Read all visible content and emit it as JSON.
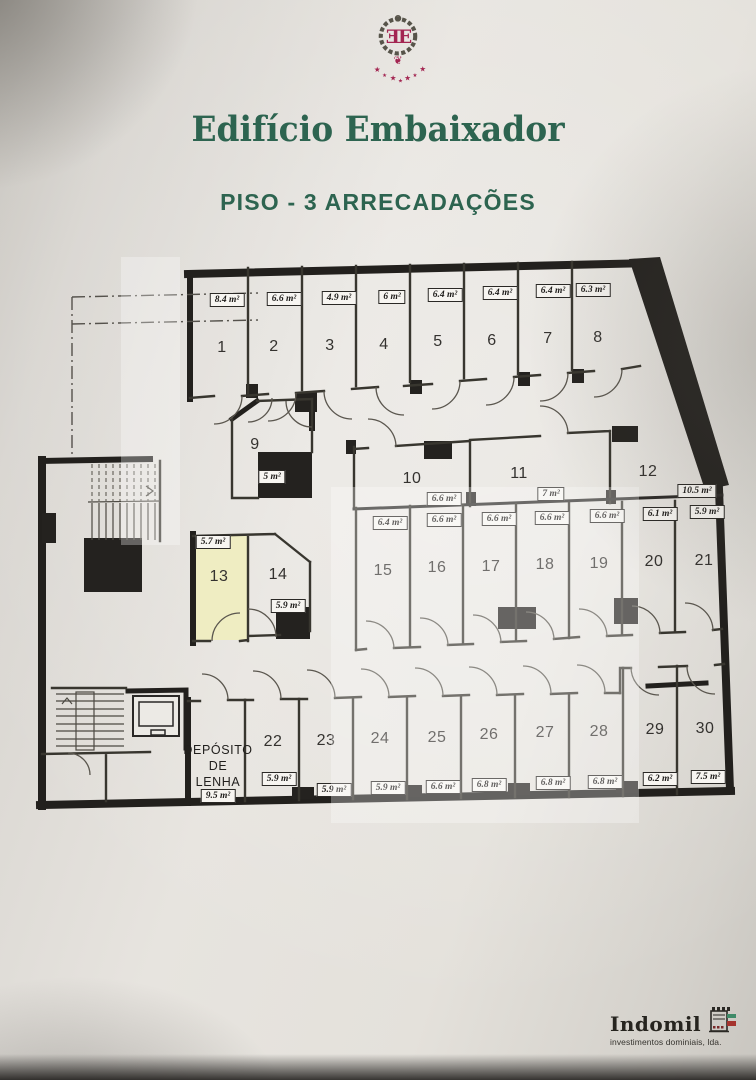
{
  "header": {
    "logo_monogram": "ƎE",
    "title": "Edifício Embaixador",
    "subtitle": "PISO - 3 ARRECADAÇÕES"
  },
  "floorplan": {
    "highlighted_room": "13",
    "rooms": [
      {
        "number": "1",
        "area": "8.4 m²"
      },
      {
        "number": "2",
        "area": "6.6 m²"
      },
      {
        "number": "3",
        "area": "4.9 m²"
      },
      {
        "number": "4",
        "area": "6 m²"
      },
      {
        "number": "5",
        "area": "6.4 m²"
      },
      {
        "number": "6",
        "area": "6.4 m²"
      },
      {
        "number": "7",
        "area": "6.4 m²"
      },
      {
        "number": "8",
        "area": "6.3 m²"
      },
      {
        "number": "9",
        "area": "5 m²"
      },
      {
        "number": "10",
        "area": "6.6 m²"
      },
      {
        "number": "11",
        "area": "7 m²"
      },
      {
        "number": "12",
        "area": "10.5 m²"
      },
      {
        "number": "13",
        "area": "5.7 m²"
      },
      {
        "number": "14",
        "area": "5.9 m²"
      },
      {
        "number": "15",
        "area": "6.4 m²"
      },
      {
        "number": "16",
        "area": "6.6 m²"
      },
      {
        "number": "17",
        "area": "6.6 m²"
      },
      {
        "number": "18",
        "area": "6.6 m²"
      },
      {
        "number": "19",
        "area": "6.6 m²"
      },
      {
        "number": "20",
        "area": "6.1 m²"
      },
      {
        "number": "21",
        "area": "5.9 m²"
      },
      {
        "number": "22",
        "area": "5.9 m²"
      },
      {
        "number": "23",
        "area": "5.9 m²"
      },
      {
        "number": "24",
        "area": "5.9 m²"
      },
      {
        "number": "25",
        "area": "6.6 m²"
      },
      {
        "number": "26",
        "area": "6.8 m²"
      },
      {
        "number": "27",
        "area": "6.8 m²"
      },
      {
        "number": "28",
        "area": "6.8 m²"
      },
      {
        "number": "29",
        "area": "6.2 m²"
      },
      {
        "number": "30",
        "area": "7.5 m²"
      }
    ],
    "deposito": {
      "name": "DEPÓSITO\nDE\nLENHA",
      "area": "9.5 m²"
    }
  },
  "footer": {
    "brand": "Indomil",
    "tagline": "investimentos dominiais, lda."
  },
  "colors": {
    "title_green": "#2d6450",
    "logo_crimson": "#a32551",
    "highlight_yellow": "#efedc2",
    "wall_dark": "#22201d"
  }
}
